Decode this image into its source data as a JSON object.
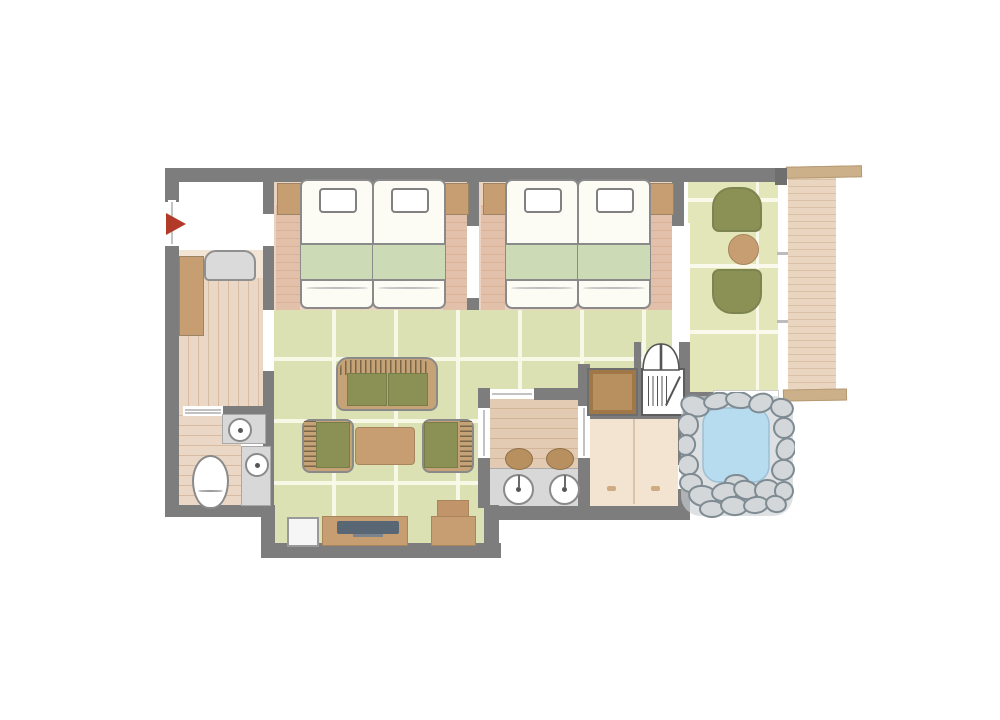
{
  "palette": {
    "wall": "#7d7d7d",
    "outline": "#8a8a8a",
    "tatami": "#dbe1b2",
    "sitting": "#e2e6b8",
    "carpet": "#ead3c1",
    "carpet_band": "#e2c0a9",
    "wood_light": "#ead7c5",
    "wood_mid": "#e3cbb3",
    "deck": "#ead6c0",
    "deck_cap": "#ccb089",
    "counter": "#d8d8d8",
    "olive": "#8b9055",
    "wicker": "#c6a377",
    "table_brown": "#c79e72",
    "chest": "#b8905f",
    "mattress": "#fcfbf4",
    "blanket": "#ccdbb5",
    "changing": "#f2e4d0",
    "step": "#f2e5d6",
    "water": "#b8dcef",
    "stone": "#d4d7d9",
    "stone_line": "#7f8b93",
    "tv": "#596673",
    "flag": "#b23a28",
    "bench": "#dadada",
    "white_floor": "#ffffff"
  },
  "scene": {
    "type": "floor-plan",
    "areas": [
      "entrance-genkan",
      "toilet-room",
      "twin-bedroom-1",
      "twin-bedroom-2",
      "tatami-living-room",
      "lounge-corner",
      "washroom-vanity",
      "changing-room",
      "open-air-rock-bath",
      "veranda-deck"
    ],
    "furniture_counts": {
      "beds": 4,
      "pillows": 4,
      "nightstands": 4,
      "sofa": 1,
      "armchairs": 2,
      "coffee_table": 1,
      "lounge_chairs": 2,
      "round_table": 1,
      "tv": 1,
      "tv_cabinet": 1,
      "side_cabinet": 1,
      "chest": 1,
      "slatted_shelf": 1,
      "double_swing_door": 1,
      "vanity_basins": 2,
      "vanity_stools": 2,
      "hand_basins": 2,
      "toilet": 1,
      "bench": 1,
      "shoe_cabinet": 1,
      "entrance_flag_marker": 1,
      "rock_bath": 1
    }
  }
}
